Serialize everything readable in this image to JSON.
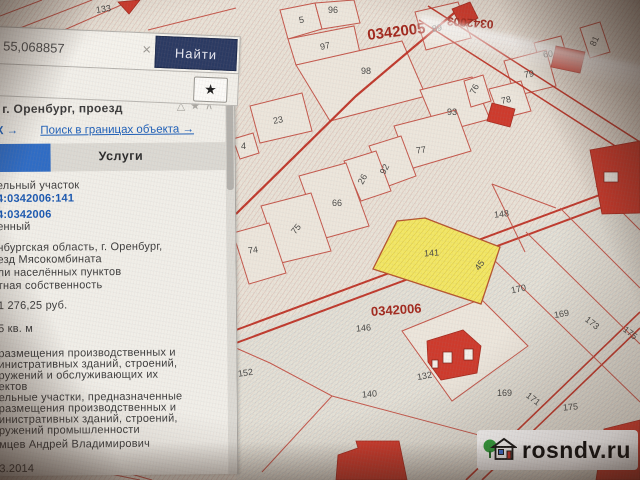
{
  "search": {
    "value": "55,068857",
    "clear_icon": "×",
    "button_label": "Найти"
  },
  "favorites": {
    "star_icon": "★"
  },
  "panel": {
    "address_header": "г. Оренбург, проезд",
    "header_icons": {
      "alert": "△",
      "star": "★",
      "collapse": "∧"
    },
    "link_left": "К →",
    "link_search_bounds": "Поиск в границах объекта →",
    "tab_services": "Услуги",
    "lines": [
      "ельный участок",
      "4:0342006:141",
      "4:0342006",
      "енный",
      "нбургская область, г. Оренбург,",
      "езд Мясокомбината",
      "ли населённых пунктов",
      "тная собственность",
      "1 276,25 руб.",
      "5 кв. м",
      "размещения производственных и",
      "инистративных зданий, строений,",
      "ружений и обслуживающих их",
      "ектов",
      "ельные участки, предназначенные",
      "размещения производственных и",
      "инистративных зданий, строений,",
      "ружений промышленности",
      "мцев Андрей Владимирович",
      "3.2014"
    ]
  },
  "map": {
    "quarters": [
      {
        "t": "0342005"
      },
      {
        "t": "0342003"
      },
      {
        "t": "0342006"
      }
    ],
    "labels": [
      {
        "t": "133"
      },
      {
        "t": "96"
      },
      {
        "t": "5"
      },
      {
        "t": "97"
      },
      {
        "t": "98"
      },
      {
        "t": "89"
      },
      {
        "t": "60"
      },
      {
        "t": "81"
      },
      {
        "t": "79"
      },
      {
        "t": "76"
      },
      {
        "t": "78"
      },
      {
        "t": "93"
      },
      {
        "t": "23"
      },
      {
        "t": "4"
      },
      {
        "t": "77"
      },
      {
        "t": "92"
      },
      {
        "t": "26"
      },
      {
        "t": "66"
      },
      {
        "t": "75"
      },
      {
        "t": "74"
      },
      {
        "t": "148"
      },
      {
        "t": "141"
      },
      {
        "t": "45"
      },
      {
        "t": "170"
      },
      {
        "t": "169"
      },
      {
        "t": "173"
      },
      {
        "t": "175"
      },
      {
        "t": "146"
      },
      {
        "t": "140"
      },
      {
        "t": "152"
      },
      {
        "t": "132"
      },
      {
        "t": "169"
      },
      {
        "t": "171"
      },
      {
        "t": "175"
      }
    ],
    "highlight_color": "#f2e766",
    "parcel_line_color": "#c4574b",
    "building_fill_color": "#cd3a2c"
  },
  "watermark": {
    "text": "rosndv.ru"
  }
}
